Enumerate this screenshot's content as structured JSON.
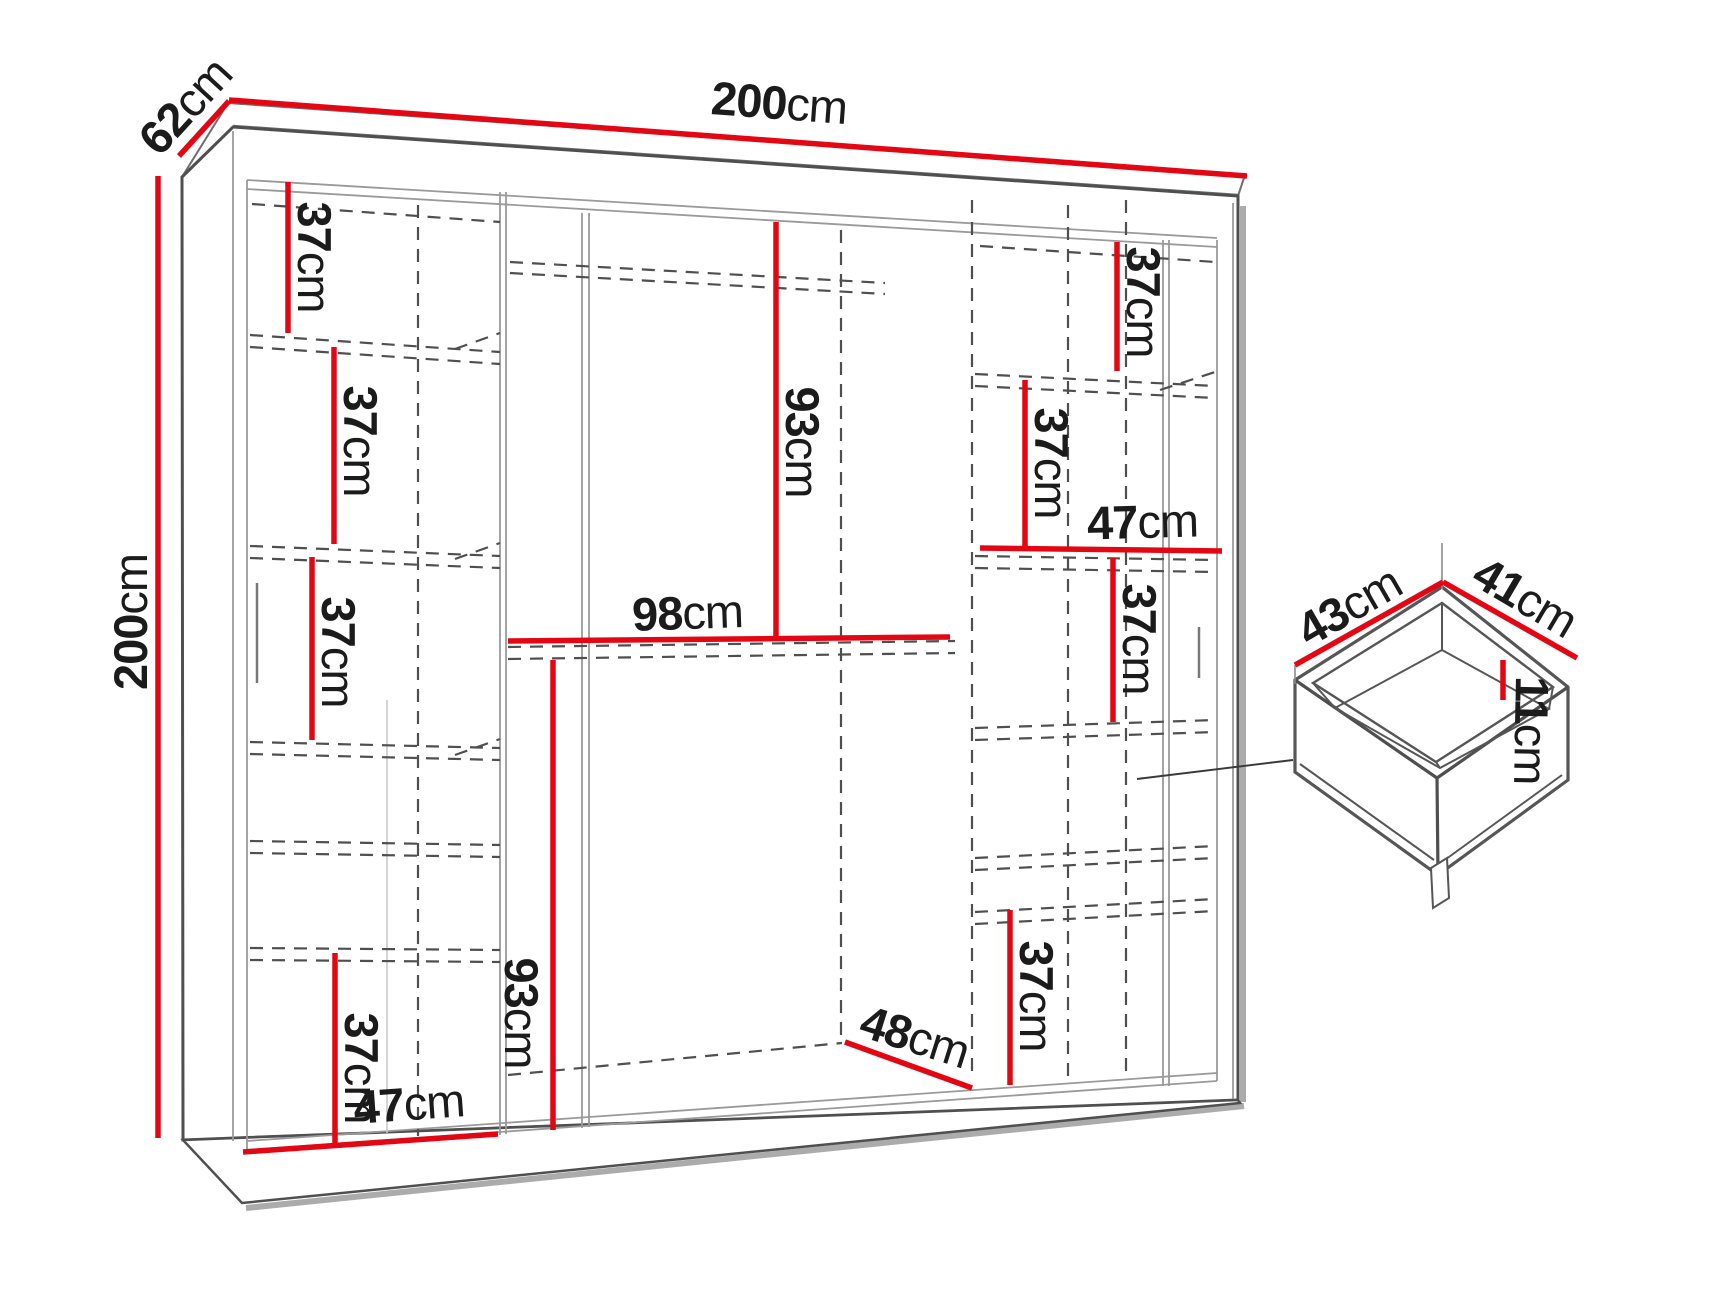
{
  "diagram": {
    "title": "Sliding wardrobe dimension diagram with drawer detail",
    "colors": {
      "dimension_red": "#e30613",
      "outline_gray": "#4f4f4f",
      "dashed_gray": "#4f4f4f",
      "shadow_gray": "#ababab",
      "text_black": "#1b1b1b"
    },
    "overall": {
      "width": {
        "num": "200",
        "unit": "cm"
      },
      "depth": {
        "num": "62",
        "unit": "cm"
      },
      "height": {
        "num": "200",
        "unit": "cm"
      }
    },
    "left_column": {
      "shelf_1": {
        "num": "37",
        "unit": "cm"
      },
      "shelf_2": {
        "num": "37",
        "unit": "cm"
      },
      "shelf_3": {
        "num": "37",
        "unit": "cm"
      },
      "shelf_4": {
        "num": "37",
        "unit": "cm"
      },
      "bottom_width": {
        "num": "47",
        "unit": "cm"
      }
    },
    "middle_section": {
      "hanging_height": {
        "num": "93",
        "unit": "cm"
      },
      "shelf_width": {
        "num": "98",
        "unit": "cm"
      },
      "lower_height": {
        "num": "93",
        "unit": "cm"
      },
      "floor_depth": {
        "num": "48",
        "unit": "cm"
      }
    },
    "right_column": {
      "shelf_1": {
        "num": "37",
        "unit": "cm"
      },
      "shelf_2": {
        "num": "37",
        "unit": "cm"
      },
      "width": {
        "num": "47",
        "unit": "cm"
      },
      "shelf_3": {
        "num": "37",
        "unit": "cm"
      },
      "shelf_4": {
        "num": "37",
        "unit": "cm"
      }
    },
    "drawer": {
      "width": {
        "num": "43",
        "unit": "cm"
      },
      "depth": {
        "num": "41",
        "unit": "cm"
      },
      "inner_height": {
        "num": "11",
        "unit": "cm"
      }
    }
  }
}
